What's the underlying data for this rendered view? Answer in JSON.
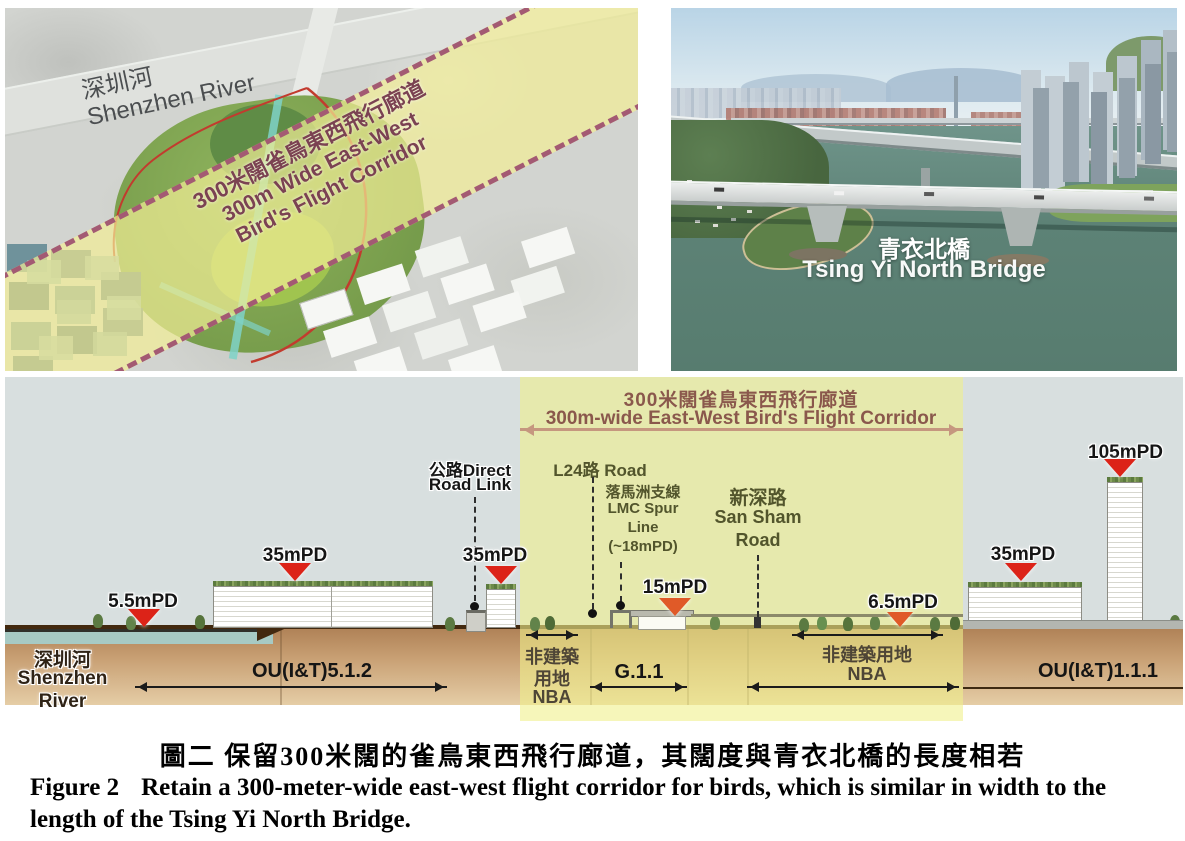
{
  "map": {
    "river_zh": "深圳河",
    "river_en": "Shenzhen River",
    "corridor_line1": "300米闊雀鳥東西飛行廊道",
    "corridor_line2": "300m Wide East-West",
    "corridor_line3": "Bird's Flight Corridor"
  },
  "photo": {
    "bridge_zh": "青衣北橋",
    "bridge_en": "Tsing Yi North Bridge"
  },
  "section": {
    "corridor_title_zh": "300米闊雀鳥東西飛行廊道",
    "corridor_title_en": "300m-wide East-West Bird's Flight Corridor",
    "river_lines": [
      "深圳河",
      "Shenzhen",
      "River"
    ],
    "markers": [
      {
        "label": "5.5mPD"
      },
      {
        "label": "35mPD"
      },
      {
        "label": "35mPD"
      },
      {
        "label": "15mPD"
      },
      {
        "label": "6.5mPD"
      },
      {
        "label": "35mPD"
      },
      {
        "label": "105mPD"
      }
    ],
    "roads": {
      "direct_line1": "公路Direct",
      "direct_line2": "Road Link",
      "l24": "L24路 Road",
      "lmc_lines": [
        "落馬洲支線",
        "LMC Spur",
        "Line",
        "(~18mPD)"
      ],
      "san_sham_lines": [
        "新深路",
        "San Sham",
        "Road"
      ]
    },
    "zones": {
      "ou512": "OU(I&T)5.1.2",
      "g11": "G.1.1",
      "ou111": "OU(I&T)1.1.1",
      "nba_left_lines": [
        "非建築",
        "用地",
        "NBA"
      ],
      "nba_right_line1": "非建築用地",
      "nba_right_line2": "NBA"
    }
  },
  "caption": {
    "zh": "圖二 保留300米闊的雀鳥東西飛行廊道，其闊度與青衣北橋的長度相若",
    "en_label": "Figure 2",
    "en_text": "Retain a 300-meter-wide east-west flight corridor for birds, which is similar in width to the length of the Tsing Yi North Bridge."
  },
  "colors": {
    "corridor_fill": "#eef0ba",
    "corridor_title": "#8a584c",
    "corridor_arrow": "#c5977f",
    "marker_red": "#dc2318",
    "marker_orange": "#e05a28",
    "sky": "#d8dfdf",
    "ground_top": "#b08257",
    "ground_bottom": "#e5cda6",
    "water": "#a7cac4",
    "map_corridor_text": "#7b4252",
    "map_dash": "#a35a73"
  }
}
